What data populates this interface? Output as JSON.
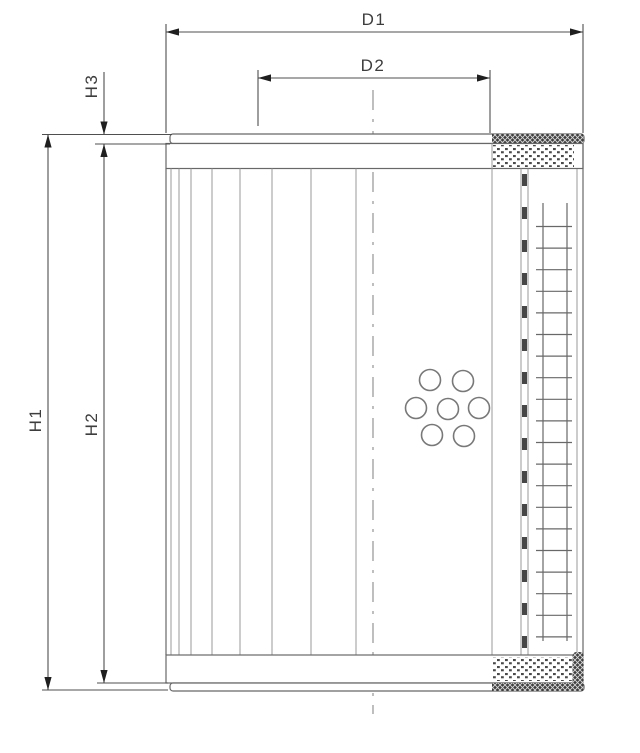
{
  "drawing": {
    "type": "technical-dimension-drawing",
    "subject": "filter-element-cross-section",
    "dimension_labels": {
      "d1": "D1",
      "d2": "D2",
      "h1": "H1",
      "h2": "H2",
      "h3": "H3"
    },
    "colors": {
      "background": "#ffffff",
      "line": "#686868",
      "line_light": "#9a9a9a",
      "dim_line": "#4f4f4f",
      "arrow": "#1f1f1f",
      "text": "#3d3d3d",
      "hatch_dark": "#3f3f3f",
      "hatch_speck": "#d8d8d8",
      "dot_hatch": "#4a4a4a"
    }
  }
}
